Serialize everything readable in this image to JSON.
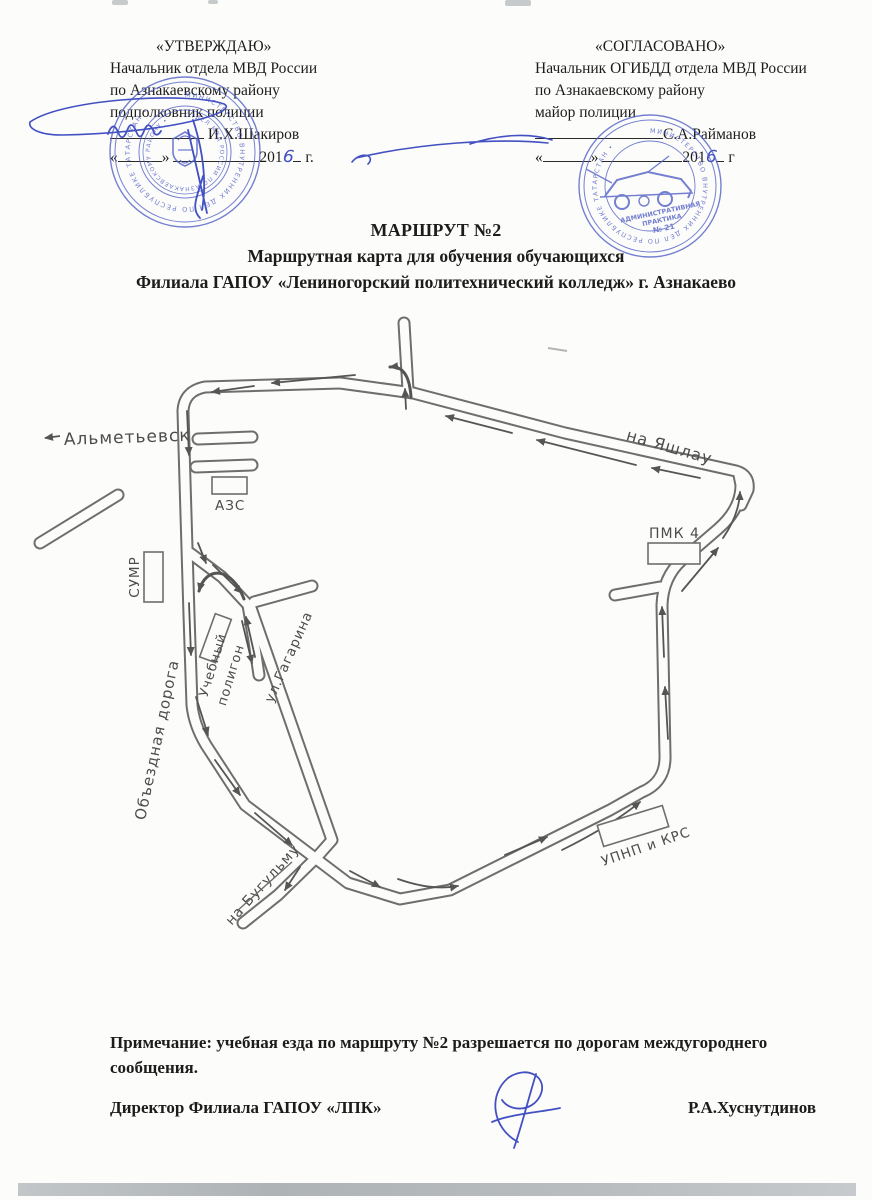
{
  "approval_left": {
    "heading": "«УТВЕРЖДАЮ»",
    "line1": "Начальник отдела МВД России",
    "line2": "по Азнакаевскому району",
    "line3": "подполковник полиции",
    "name": "И.Х.Шакиров",
    "date_open": "«",
    "date_close": "»",
    "year": "201",
    "year_hand": "6",
    "year_suffix": "г."
  },
  "approval_right": {
    "heading": "«СОГЛАСОВАНО»",
    "line1": "Начальник ОГИБДД отдела МВД России",
    "line2": "по Азнакаевскому району",
    "line3": "майор полиции",
    "name": "С.А.Райманов",
    "date_open": "«",
    "date_close": "»",
    "year": "201",
    "year_hand": "6",
    "year_suffix": "г"
  },
  "title": {
    "line1": "МАРШРУТ №2",
    "line2": "Маршрутная карта для обучения обучающихся",
    "line3": "Филиала ГАПОУ «Лениногорский политехнический колледж» г. Азнакаево"
  },
  "map": {
    "labels": {
      "almetyevsk": "Альметьевск",
      "yashlau": "на Яшлау",
      "azs": "АЗС",
      "sumr": "СУМР",
      "poligon_line1": "Учебный",
      "poligon_line2": "полигон",
      "gagarina": "ул.Гагарина",
      "obezdnaya": "Объездная дорога",
      "bugulma": "на Бугульму",
      "upnp": "УПНП и КРС",
      "pmk": "ПМК 4"
    },
    "accent_ink_color": "#4250c2",
    "road_color": "#666666"
  },
  "stamps": {
    "left_ring_text": "МИНИСТЕРСТВО ВНУТРЕННИХ ДЕЛ ПО РЕСПУБЛИКЕ ТАТАРСТАН •",
    "left_inner_text": "ОТДЕЛ МВД РОССИИ ПО АЗНАКАЕВСКОМУ РАЙОНУ •",
    "right_ring_text": "МИНИСТЕРСТВО ВНУТРЕННИХ ДЕЛ ПО РЕСПУБЛИКЕ ТАТАРСТАН •",
    "right_center_line1": "АДМИНИСТРАТИВНАЯ",
    "right_center_line2": "ПРАКТИКА",
    "right_center_line3": "№ 21"
  },
  "note": "Примечание: учебная езда по маршруту №2 разрешается по дорогам междугороднего сообщения.",
  "footer": {
    "position": "Директор Филиала ГАПОУ «ЛПК»",
    "name": "Р.А.Хуснутдинов"
  }
}
